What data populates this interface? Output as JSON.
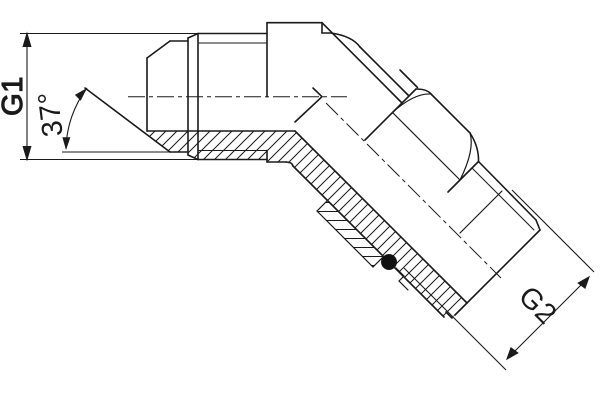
{
  "drawing": {
    "type": "technical-section-drawing",
    "subject": "45-degree adjustable elbow hydraulic fitting, half-section view",
    "colors": {
      "line": "#1a1a1a",
      "background": "#ffffff",
      "seal": "#111111"
    },
    "dimensions": {
      "g1": {
        "label": "G1",
        "kind": "thread-size-vertical"
      },
      "angle": {
        "label": "37°",
        "kind": "flare-cone-angle"
      },
      "g2": {
        "label": "G2",
        "kind": "thread-size-diagonal"
      }
    },
    "features": [
      "male-37deg-flare-end",
      "hex-body",
      "45deg-elbow",
      "locknut-sectioned",
      "o-ring-seal",
      "male-stud-thread",
      "centerlines-dash-dot",
      "section-hatching"
    ]
  }
}
